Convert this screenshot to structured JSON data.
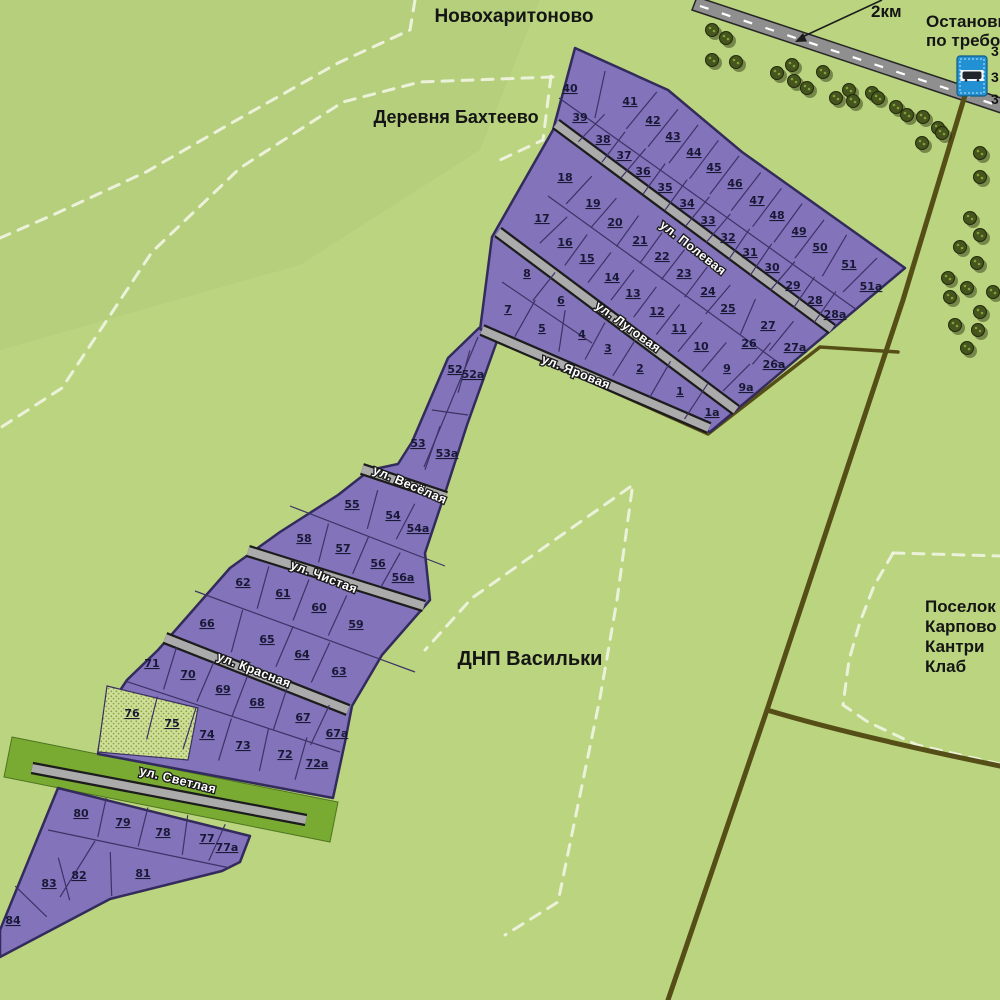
{
  "map": {
    "colors": {
      "background": "#bad47f",
      "plot_purple": "#8273bb",
      "plot_border": "#332b5c",
      "street_gray": "#ababab",
      "street_casing": "#1c1c1c",
      "highway_gray": "#8f8f8f",
      "dirt_track": "#554e16",
      "green_verge": "#79ab33",
      "sold_fill": "#cfe096",
      "sold_dot": "#8aa24f",
      "boundary_dash": "#f2f5e4",
      "tree_green": "#46541d",
      "bus_sign_blue": "#2191d4",
      "label_dark": "#151515"
    },
    "place_labels": [
      {
        "id": "novokharitonovo",
        "text": "Новохаритоново",
        "x": 514,
        "y": 22,
        "size": 19,
        "anchor": "middle"
      },
      {
        "id": "derevnya-bakhteevo",
        "text": "Деревня Бахтеево",
        "x": 456,
        "y": 123,
        "size": 18,
        "anchor": "middle"
      },
      {
        "id": "dnp-vasilki",
        "text": "ДНП Васильки",
        "x": 530,
        "y": 665,
        "size": 20,
        "anchor": "middle"
      },
      {
        "id": "karpovo-line1",
        "text": "Поселок",
        "x": 925,
        "y": 612,
        "size": 17,
        "anchor": "start"
      },
      {
        "id": "karpovo-line2",
        "text": "Карпово",
        "x": 925,
        "y": 632,
        "size": 17,
        "anchor": "start"
      },
      {
        "id": "karpovo-line3",
        "text": "Кантри",
        "x": 925,
        "y": 652,
        "size": 17,
        "anchor": "start"
      },
      {
        "id": "karpovo-line4",
        "text": "Клаб",
        "x": 925,
        "y": 672,
        "size": 17,
        "anchor": "start"
      },
      {
        "id": "bus-stop-line1",
        "text": "Остановка",
        "x": 926,
        "y": 27,
        "size": 17,
        "anchor": "start"
      },
      {
        "id": "bus-stop-line2",
        "text": "по требованию",
        "x": 926,
        "y": 46,
        "size": 17,
        "anchor": "start"
      },
      {
        "id": "distance-2km",
        "text": "2км",
        "x": 871,
        "y": 17,
        "size": 17,
        "anchor": "start"
      },
      {
        "id": "route-cut-1",
        "text": "3",
        "x": 991,
        "y": 56,
        "size": 14,
        "anchor": "start"
      },
      {
        "id": "route-cut-2",
        "text": "3",
        "x": 991,
        "y": 82,
        "size": 14,
        "anchor": "start"
      },
      {
        "id": "route-cut-3",
        "text": "3",
        "x": 991,
        "y": 104,
        "size": 14,
        "anchor": "start"
      }
    ],
    "streets": [
      {
        "name": "ул. Полевая",
        "x": 693,
        "y": 248,
        "angle": 38
      },
      {
        "name": "ул. Луговая",
        "x": 628,
        "y": 327,
        "angle": 36
      },
      {
        "name": "ул. Яровая",
        "x": 576,
        "y": 372,
        "angle": 22
      },
      {
        "name": "ул. Весёлая",
        "x": 410,
        "y": 485,
        "angle": 23
      },
      {
        "name": "ул. Чистая",
        "x": 324,
        "y": 577,
        "angle": 21
      },
      {
        "name": "ул. Красная",
        "x": 254,
        "y": 670,
        "angle": 21
      },
      {
        "name": "ул. Светлая",
        "x": 178,
        "y": 780,
        "angle": 14
      }
    ],
    "sold_plot_ids": [
      "75",
      "76"
    ],
    "plots": [
      {
        "id": "40",
        "x": 570,
        "y": 88
      },
      {
        "id": "41",
        "x": 630,
        "y": 101
      },
      {
        "id": "42",
        "x": 653,
        "y": 120
      },
      {
        "id": "43",
        "x": 673,
        "y": 136
      },
      {
        "id": "44",
        "x": 694,
        "y": 152
      },
      {
        "id": "45",
        "x": 714,
        "y": 167
      },
      {
        "id": "46",
        "x": 735,
        "y": 183
      },
      {
        "id": "47",
        "x": 757,
        "y": 200
      },
      {
        "id": "48",
        "x": 777,
        "y": 215
      },
      {
        "id": "49",
        "x": 799,
        "y": 231
      },
      {
        "id": "50",
        "x": 820,
        "y": 247
      },
      {
        "id": "51",
        "x": 849,
        "y": 264
      },
      {
        "id": "51а",
        "x": 871,
        "y": 286
      },
      {
        "id": "39",
        "x": 580,
        "y": 117
      },
      {
        "id": "38",
        "x": 603,
        "y": 139
      },
      {
        "id": "37",
        "x": 624,
        "y": 155
      },
      {
        "id": "36",
        "x": 643,
        "y": 171
      },
      {
        "id": "35",
        "x": 665,
        "y": 187
      },
      {
        "id": "34",
        "x": 687,
        "y": 203
      },
      {
        "id": "33",
        "x": 708,
        "y": 220
      },
      {
        "id": "32",
        "x": 728,
        "y": 237
      },
      {
        "id": "31",
        "x": 750,
        "y": 252
      },
      {
        "id": "30",
        "x": 772,
        "y": 267
      },
      {
        "id": "29",
        "x": 793,
        "y": 285
      },
      {
        "id": "28",
        "x": 815,
        "y": 300
      },
      {
        "id": "28а",
        "x": 835,
        "y": 314
      },
      {
        "id": "18",
        "x": 565,
        "y": 177
      },
      {
        "id": "19",
        "x": 593,
        "y": 203
      },
      {
        "id": "20",
        "x": 615,
        "y": 222
      },
      {
        "id": "21",
        "x": 640,
        "y": 240
      },
      {
        "id": "22",
        "x": 662,
        "y": 256
      },
      {
        "id": "23",
        "x": 684,
        "y": 273
      },
      {
        "id": "24",
        "x": 708,
        "y": 291
      },
      {
        "id": "25",
        "x": 728,
        "y": 308
      },
      {
        "id": "27",
        "x": 768,
        "y": 325
      },
      {
        "id": "27а",
        "x": 795,
        "y": 347
      },
      {
        "id": "17",
        "x": 542,
        "y": 218
      },
      {
        "id": "16",
        "x": 565,
        "y": 242
      },
      {
        "id": "15",
        "x": 587,
        "y": 258
      },
      {
        "id": "14",
        "x": 612,
        "y": 277
      },
      {
        "id": "13",
        "x": 633,
        "y": 293
      },
      {
        "id": "12",
        "x": 657,
        "y": 311
      },
      {
        "id": "11",
        "x": 679,
        "y": 328
      },
      {
        "id": "10",
        "x": 701,
        "y": 346
      },
      {
        "id": "9",
        "x": 727,
        "y": 368
      },
      {
        "id": "9а",
        "x": 746,
        "y": 387
      },
      {
        "id": "26",
        "x": 749,
        "y": 343
      },
      {
        "id": "26а",
        "x": 774,
        "y": 364
      },
      {
        "id": "8",
        "x": 527,
        "y": 273
      },
      {
        "id": "6",
        "x": 561,
        "y": 300
      },
      {
        "id": "7",
        "x": 508,
        "y": 309
      },
      {
        "id": "5",
        "x": 542,
        "y": 328
      },
      {
        "id": "4",
        "x": 582,
        "y": 334
      },
      {
        "id": "3",
        "x": 608,
        "y": 348
      },
      {
        "id": "2",
        "x": 640,
        "y": 368
      },
      {
        "id": "1",
        "x": 680,
        "y": 391
      },
      {
        "id": "1а",
        "x": 712,
        "y": 412
      },
      {
        "id": "52",
        "x": 455,
        "y": 369
      },
      {
        "id": "52а",
        "x": 473,
        "y": 374
      },
      {
        "id": "53",
        "x": 418,
        "y": 443
      },
      {
        "id": "53а",
        "x": 447,
        "y": 453
      },
      {
        "id": "55",
        "x": 352,
        "y": 504
      },
      {
        "id": "54",
        "x": 393,
        "y": 515
      },
      {
        "id": "54а",
        "x": 418,
        "y": 528
      },
      {
        "id": "58",
        "x": 304,
        "y": 538
      },
      {
        "id": "57",
        "x": 343,
        "y": 548
      },
      {
        "id": "56",
        "x": 378,
        "y": 563
      },
      {
        "id": "56а",
        "x": 403,
        "y": 577
      },
      {
        "id": "62",
        "x": 243,
        "y": 582
      },
      {
        "id": "61",
        "x": 283,
        "y": 593
      },
      {
        "id": "60",
        "x": 319,
        "y": 607
      },
      {
        "id": "59",
        "x": 356,
        "y": 624
      },
      {
        "id": "66",
        "x": 207,
        "y": 623
      },
      {
        "id": "65",
        "x": 267,
        "y": 639
      },
      {
        "id": "64",
        "x": 302,
        "y": 654
      },
      {
        "id": "63",
        "x": 339,
        "y": 671
      },
      {
        "id": "71",
        "x": 152,
        "y": 663
      },
      {
        "id": "70",
        "x": 188,
        "y": 674
      },
      {
        "id": "69",
        "x": 223,
        "y": 689
      },
      {
        "id": "68",
        "x": 257,
        "y": 702
      },
      {
        "id": "67",
        "x": 303,
        "y": 717
      },
      {
        "id": "67а",
        "x": 337,
        "y": 733
      },
      {
        "id": "76",
        "x": 132,
        "y": 713
      },
      {
        "id": "75",
        "x": 172,
        "y": 723
      },
      {
        "id": "74",
        "x": 207,
        "y": 734
      },
      {
        "id": "73",
        "x": 243,
        "y": 745
      },
      {
        "id": "72",
        "x": 285,
        "y": 754
      },
      {
        "id": "72а",
        "x": 317,
        "y": 763
      },
      {
        "id": "80",
        "x": 81,
        "y": 813
      },
      {
        "id": "79",
        "x": 123,
        "y": 822
      },
      {
        "id": "78",
        "x": 163,
        "y": 832
      },
      {
        "id": "77",
        "x": 207,
        "y": 838
      },
      {
        "id": "77а",
        "x": 227,
        "y": 847
      },
      {
        "id": "84",
        "x": 13,
        "y": 920
      },
      {
        "id": "83",
        "x": 49,
        "y": 883
      },
      {
        "id": "82",
        "x": 79,
        "y": 875
      },
      {
        "id": "81",
        "x": 143,
        "y": 873
      }
    ],
    "plot_rows": [
      {
        "ids": [
          "40",
          "41",
          "42",
          "43",
          "44",
          "45",
          "46",
          "47",
          "48",
          "49",
          "50",
          "51",
          "51а"
        ],
        "len": 48
      },
      {
        "ids": [
          "39",
          "38",
          "37",
          "36",
          "35",
          "34",
          "33",
          "32",
          "31",
          "30",
          "29",
          "28",
          "28а"
        ],
        "len": 38
      },
      {
        "ids": [
          "18",
          "19",
          "20",
          "21",
          "22",
          "23",
          "24",
          "25",
          "27",
          "27а"
        ],
        "len": 38
      },
      {
        "ids": [
          "17",
          "16",
          "15",
          "14",
          "13",
          "12",
          "11",
          "10",
          "9",
          "9а"
        ],
        "len": 38
      },
      {
        "ids": [
          "26",
          "26а"
        ],
        "len": 28
      },
      {
        "ids": [
          "8",
          "6"
        ],
        "len": 36
      },
      {
        "ids": [
          "7",
          "5",
          "4",
          "3",
          "2",
          "1",
          "1а"
        ],
        "len": 42
      },
      {
        "ids": [
          "52",
          "52а"
        ],
        "len": 44
      },
      {
        "ids": [
          "53",
          "53а"
        ],
        "len": 46
      },
      {
        "ids": [
          "55",
          "54",
          "54а"
        ],
        "len": 40
      },
      {
        "ids": [
          "58",
          "57",
          "56",
          "56а"
        ],
        "len": 40
      },
      {
        "ids": [
          "62",
          "61",
          "60",
          "59"
        ],
        "len": 44
      },
      {
        "ids": [
          "66",
          "65",
          "64",
          "63"
        ],
        "len": 44
      },
      {
        "ids": [
          "71",
          "70",
          "69",
          "68",
          "67",
          "67а"
        ],
        "len": 44
      },
      {
        "ids": [
          "76",
          "75",
          "74",
          "73",
          "72",
          "72а"
        ],
        "len": 44
      },
      {
        "ids": [
          "80",
          "79",
          "78",
          "77",
          "77а"
        ],
        "len": 40
      },
      {
        "ids": [
          "84",
          "83",
          "82",
          "81"
        ],
        "len": 44
      }
    ],
    "geometry": {
      "shapes": [
        {
          "n": "region-tint",
          "c": "tint",
          "poly": "0,0 540,0 480,150 300,265 0,350"
        },
        {
          "n": "boundary-dash",
          "c": "border-dash",
          "path": "M415,0 L410,30 L338,63 L228,125 L146,172 L55,214 L0,238"
        },
        {
          "n": "boundary-dash",
          "c": "border-dash",
          "path": "M553,77 L420,82 L343,102 L240,168 L152,252 L62,388 L0,428"
        },
        {
          "n": "boundary-dash",
          "c": "border-dash",
          "path": "M551,76 L543,140 L500,160"
        },
        {
          "n": "boundary-dash",
          "c": "border-dash",
          "path": "M630,487 L472,598 L425,650"
        },
        {
          "n": "boundary-dash",
          "c": "border-dash",
          "path": "M632,490 L617,600 L600,698 L558,902 L505,935"
        },
        {
          "n": "boundary-dash",
          "c": "border-dash",
          "path": "M893,553 L1000,556"
        },
        {
          "n": "boundary-dash",
          "c": "border-dash",
          "path": "M893,553 L874,586 L860,622 L849,660 L843,705 L868,722 L917,745 L1000,764"
        },
        {
          "n": "highway-road",
          "c": "hw",
          "poly": "697,-3 1004,99 1004,114 692,10"
        },
        {
          "n": "highway-centerline",
          "c": "hw-dash",
          "path": "M700,6 L1002,107"
        },
        {
          "n": "dirt-road-main",
          "c": "track",
          "path": "M972,72 L903,300 L767,710 L668,1000"
        },
        {
          "n": "dirt-road-branch",
          "c": "track",
          "path": "M767,710 Q850,735 1000,766"
        },
        {
          "n": "dirt-road-west",
          "c": "track-thin",
          "path": "M898,352 L820,347 L708,434 L489,336"
        },
        {
          "n": "green-verge",
          "c": "gband",
          "poly": "12,737 338,802 330,842 4,777"
        },
        {
          "n": "block-upper",
          "c": "block",
          "poly": "575,48 668,90 742,152 905,268 710,432 480,330 492,237 553,130"
        },
        {
          "n": "block-middle",
          "c": "block",
          "poly": "479,328 497,341 467,425 446,490 425,553 430,600 382,655 352,706 345,742 333,798 98,754 105,713 127,680 158,650 230,568 280,532 338,495 370,470 398,464 412,442 430,400 448,358"
        },
        {
          "n": "block-bottom",
          "c": "block",
          "poly": "58,788 250,836 240,862 222,871 110,899 0,957 0,930"
        },
        {
          "n": "sold-plots-area",
          "c": "sold",
          "poly": "107,686 198,708 188,760 98,752"
        }
      ],
      "street_lines": [
        [
          556,
          124,
          832,
          329
        ],
        [
          498,
          232,
          736,
          410
        ],
        [
          482,
          330,
          709,
          428
        ],
        [
          362,
          469,
          446,
          497
        ],
        [
          248,
          551,
          424,
          606
        ],
        [
          165,
          638,
          348,
          710
        ],
        [
          32,
          768,
          306,
          820
        ]
      ],
      "dividers": [
        [
          559,
          98,
          857,
          310
        ],
        [
          548,
          196,
          786,
          368
        ],
        [
          502,
          282,
          592,
          343
        ],
        [
          290,
          506,
          445,
          566
        ],
        [
          195,
          591,
          415,
          672
        ],
        [
          125,
          681,
          340,
          752
        ],
        [
          478,
          337,
          424,
          467
        ],
        [
          432,
          410,
          468,
          415
        ],
        [
          48,
          830,
          230,
          868
        ],
        [
          95,
          841,
          60,
          897
        ]
      ]
    },
    "trees": [
      [
        712,
        30
      ],
      [
        726,
        38
      ],
      [
        712,
        60
      ],
      [
        736,
        62
      ],
      [
        777,
        73
      ],
      [
        792,
        65
      ],
      [
        794,
        81
      ],
      [
        807,
        88
      ],
      [
        823,
        72
      ],
      [
        836,
        98
      ],
      [
        849,
        90
      ],
      [
        853,
        101
      ],
      [
        872,
        93
      ],
      [
        878,
        98
      ],
      [
        896,
        107
      ],
      [
        907,
        115
      ],
      [
        923,
        117
      ],
      [
        938,
        128
      ],
      [
        922,
        143
      ],
      [
        942,
        133
      ],
      [
        980,
        153
      ],
      [
        980,
        177
      ],
      [
        970,
        218
      ],
      [
        980,
        235
      ],
      [
        960,
        247
      ],
      [
        977,
        263
      ],
      [
        948,
        278
      ],
      [
        967,
        288
      ],
      [
        993,
        292
      ],
      [
        950,
        297
      ],
      [
        980,
        312
      ],
      [
        955,
        325
      ],
      [
        978,
        330
      ],
      [
        967,
        348
      ]
    ],
    "bus_sign": {
      "x": 957,
      "y": 56,
      "w": 30,
      "h": 40
    },
    "arrow": {
      "line": "M882,0 L800,38",
      "head": "795,42 807,41.5 803,33"
    }
  }
}
